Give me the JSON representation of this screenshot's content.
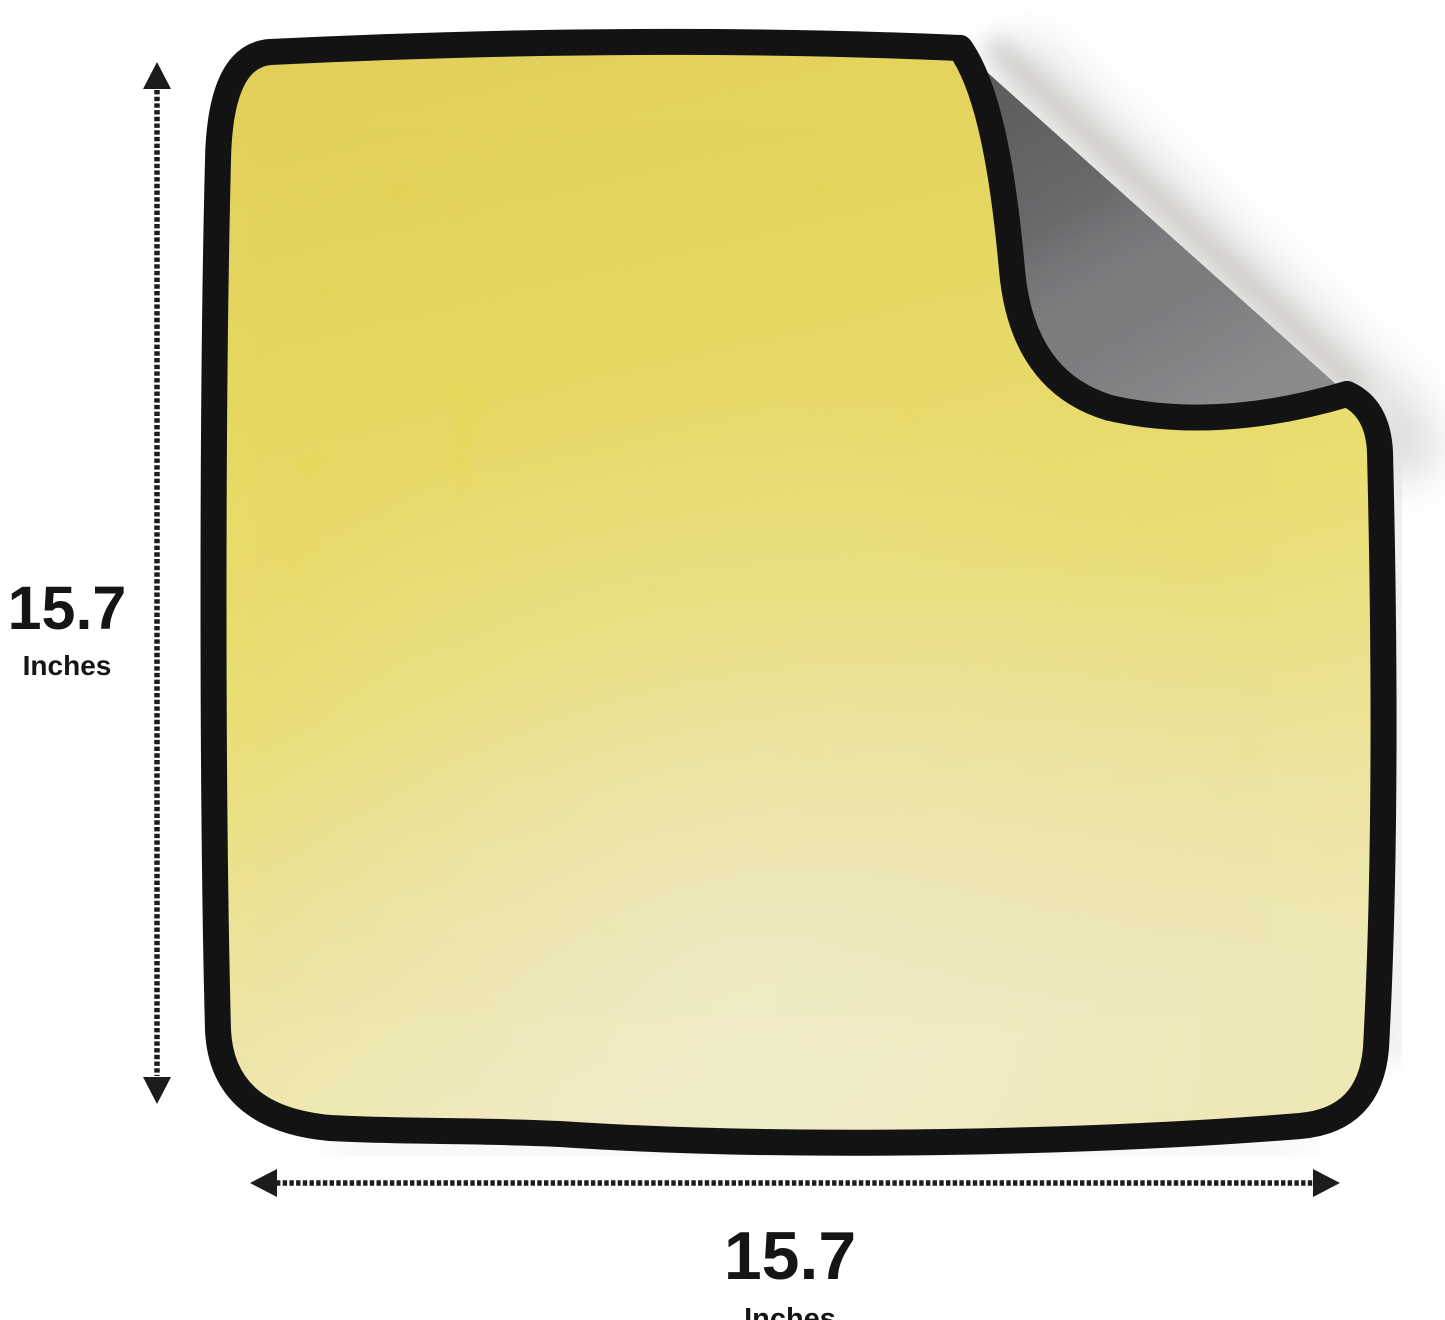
{
  "image": {
    "subject": "microfiber towel, yellow front with black trim, top-right corner folded over showing gray back side",
    "background": "#ffffff"
  },
  "dimensions": {
    "height": {
      "value": "15.7",
      "unit": "Inches"
    },
    "width": {
      "value": "15.7",
      "unit": "Inches"
    }
  },
  "icons": {
    "height_arrow": "vertical-double-headed-dashed-arrow",
    "width_arrow": "horizontal-double-headed-dashed-arrow"
  },
  "colors": {
    "towel_front": "#f4e245",
    "towel_front_pale": "#f8f0a6",
    "towel_back": "#4b4b4f",
    "trim": "#131313",
    "arrow": "#1c1c1c",
    "text": "#151515",
    "shadow": "#cbc8c5",
    "background": "#ffffff"
  }
}
